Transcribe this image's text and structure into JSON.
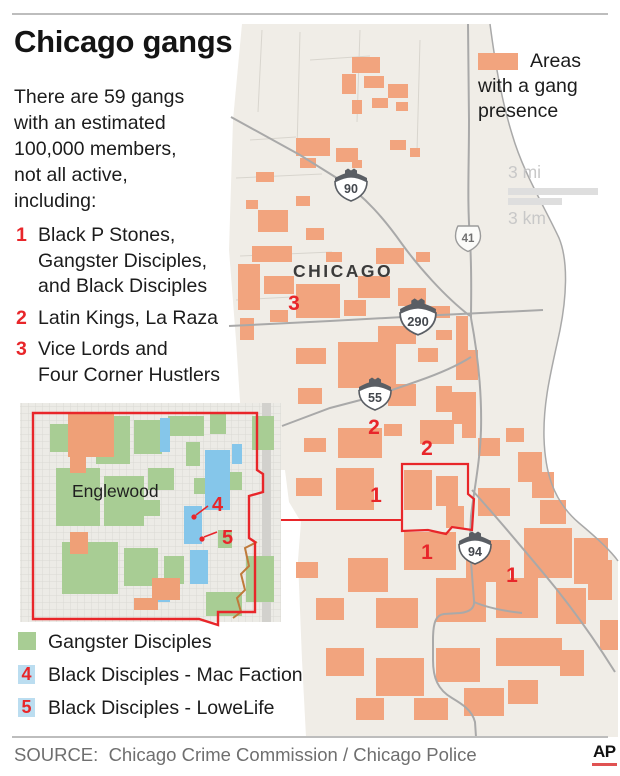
{
  "title": "Chicago gangs",
  "intro": "There are 59 gangs\nwith an estimated\n100,000 members,\nnot all active,\nincluding:",
  "gang_list": [
    {
      "num": "1",
      "label": "Black P Stones,\nGangster Disciples,\nand Black Disciples"
    },
    {
      "num": "2",
      "label": "Latin Kings, La Raza"
    },
    {
      "num": "3",
      "label": "Vice Lords and\nFour Corner Hustlers"
    }
  ],
  "area_legend": {
    "label": "Areas with a gang presence"
  },
  "scale": {
    "mi_label": "3 mi",
    "km_label": "3 km"
  },
  "map": {
    "city_label": "CHICAGO",
    "shields": [
      {
        "kind": "interstate",
        "num": "90",
        "x": 351,
        "y": 186,
        "s": 1
      },
      {
        "kind": "us",
        "num": "41",
        "x": 468,
        "y": 238,
        "s": 1
      },
      {
        "kind": "interstate",
        "num": "290",
        "x": 418,
        "y": 318,
        "s": 1.12
      },
      {
        "kind": "interstate",
        "num": "55",
        "x": 375,
        "y": 395,
        "s": 1
      },
      {
        "kind": "interstate",
        "num": "94",
        "x": 475,
        "y": 549,
        "s": 1
      }
    ],
    "markers": [
      {
        "num": "3",
        "x": 294,
        "y": 310
      },
      {
        "num": "2",
        "x": 374,
        "y": 434
      },
      {
        "num": "2",
        "x": 427,
        "y": 455
      },
      {
        "num": "1",
        "x": 376,
        "y": 502
      },
      {
        "num": "1",
        "x": 427,
        "y": 559
      },
      {
        "num": "1",
        "x": 512,
        "y": 582
      }
    ]
  },
  "inset": {
    "label": "Englewood",
    "markers": [
      {
        "num": "4",
        "tx": 212,
        "ty": 511,
        "dx": 194,
        "dy": 517,
        "lx": 208,
        "ly": 506
      },
      {
        "num": "5",
        "tx": 222,
        "ty": 544,
        "dx": 202,
        "dy": 539,
        "lx": 217,
        "ly": 532
      }
    ]
  },
  "inset_legend": [
    {
      "type": "swatch",
      "label": "Gangster Disciples"
    },
    {
      "type": "num",
      "num": "4",
      "label": "Black Disciples - Mac Faction"
    },
    {
      "type": "num",
      "num": "5",
      "label": "Black Disciples - LoweLife"
    }
  ],
  "source": "SOURCE:  Chicago Crime Commission / Chicago Police",
  "logo": "AP",
  "colors": {
    "gang_area_orange": "#F2A47E",
    "marker_red": "#E8262A",
    "gd_green": "#A8CD94",
    "bd_blue_map": "#85C6EA",
    "bd_blue_legend": "#BBDDF0",
    "land": "#F0EDE7",
    "road_gray": "#A9A9A9"
  }
}
